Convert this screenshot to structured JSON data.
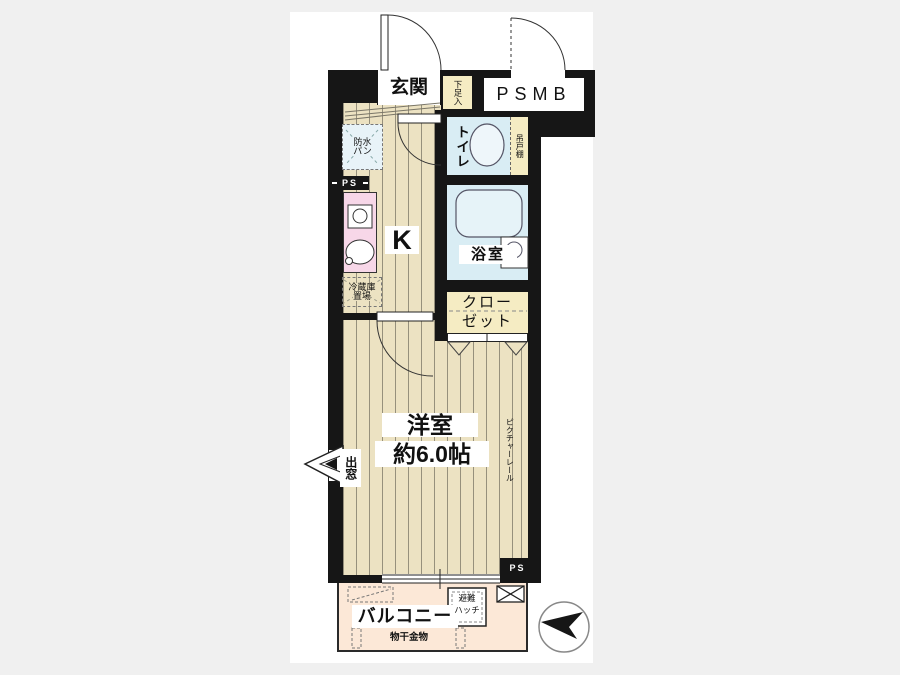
{
  "title": "1K apartment floor plan",
  "colors": {
    "bg": "#f0f0f0",
    "canvas": "#ffffff",
    "wall": "#161616",
    "floor": "#ece2c2",
    "wet": "#d9edf4",
    "cream": "#f5ecc3",
    "pink": "#f7d7e8",
    "balcony": "#fce8d7"
  },
  "labels": {
    "genkan": "玄関",
    "shoe_box": "下足入",
    "psmb": "PSMB",
    "toilet": "トイレ",
    "hanging_shelf": "吊戸棚",
    "bath": "浴室",
    "closet_l1": "クロー",
    "closet_l2": "ゼット",
    "kitchen": "K",
    "waterproof_l1": "防水",
    "waterproof_l2": "パン",
    "fridge_l1": "冷蔵庫",
    "fridge_l2": "置場",
    "room_l1": "洋室",
    "room_l2": "約6.0帖",
    "picture_rail": "ピクチャーレール",
    "bay_window": "出窓",
    "balcony": "バルコニー",
    "hatch_l1": "避難",
    "hatch_l2": "ハッチ",
    "laundry_fitting": "物干金物",
    "ps_left": "PS",
    "ps_bottom": "PS"
  }
}
